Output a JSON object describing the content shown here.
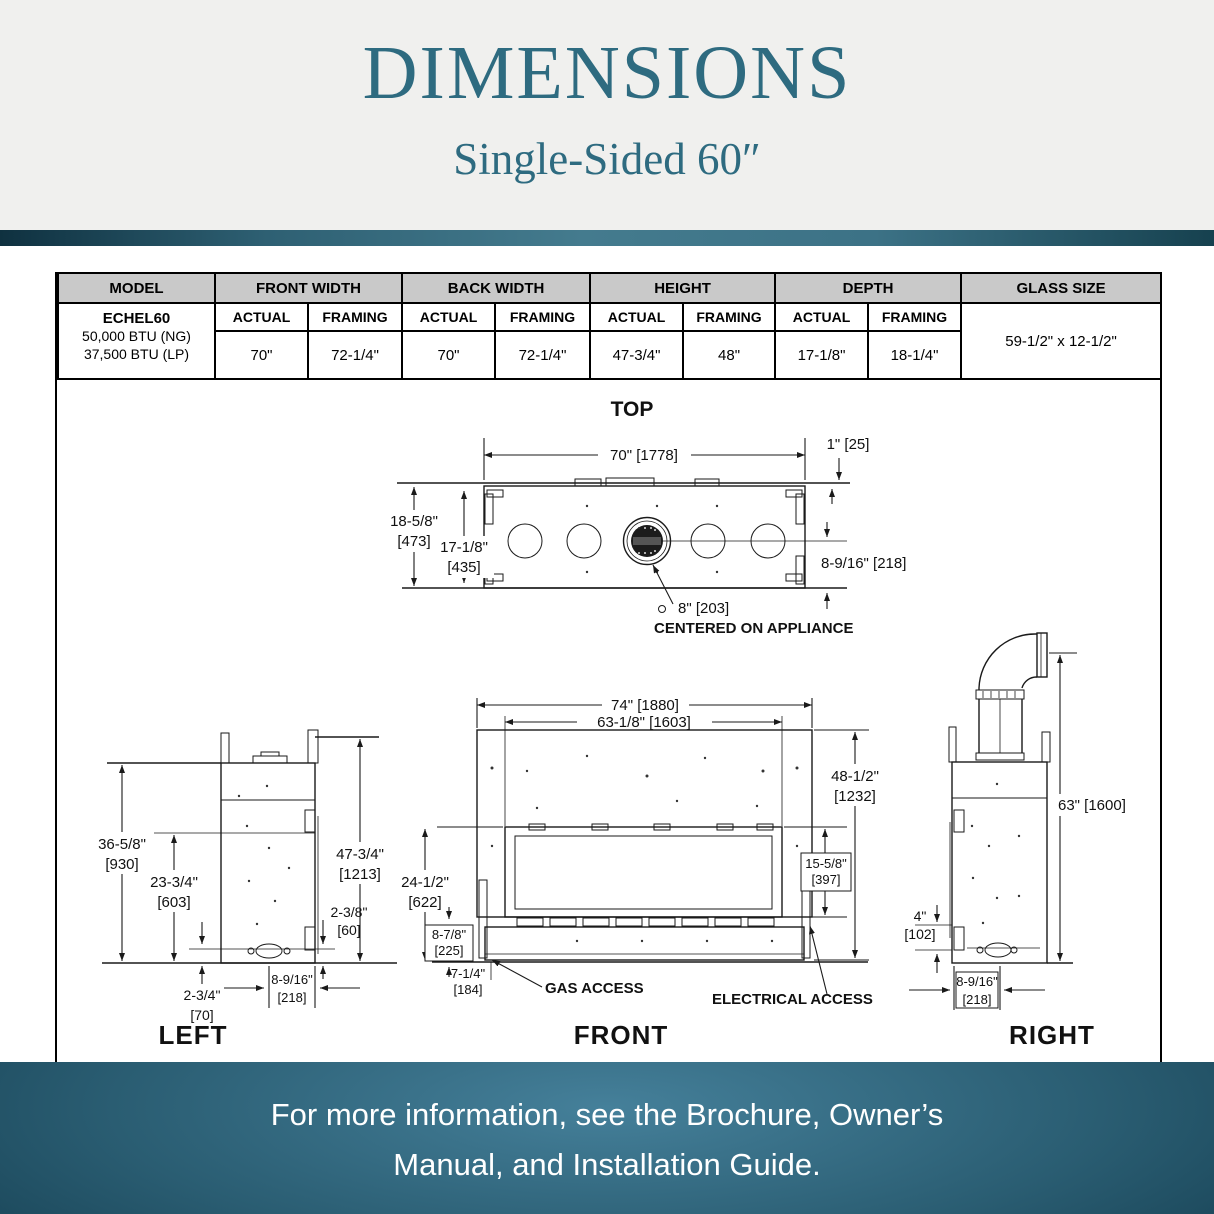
{
  "header": {
    "title": "DIMENSIONS",
    "subtitle": "Single-Sided 60″"
  },
  "spec_table": {
    "model_header": "MODEL",
    "group_headers": [
      "FRONT WIDTH",
      "BACK WIDTH",
      "HEIGHT",
      "DEPTH"
    ],
    "glass_header": "GLASS SIZE",
    "sub_headers": [
      "ACTUAL",
      "FRAMING",
      "ACTUAL",
      "FRAMING",
      "ACTUAL",
      "FRAMING",
      "ACTUAL",
      "FRAMING"
    ],
    "model_name": "ECHEL60",
    "model_btu_ng": "50,000 BTU (NG)",
    "model_btu_lp": "37,500 BTU (LP)",
    "values": [
      "70\"",
      "72-1/4\"",
      "70\"",
      "72-1/4\"",
      "47-3/4\"",
      "48\"",
      "17-1/8\"",
      "18-1/4\""
    ],
    "glass_value": "59-1/2\" x 12-1/2\""
  },
  "views": {
    "top": {
      "title": "TOP",
      "width": "70\" [1778]",
      "flange": "1\" [25]",
      "depth_outer_in": "18-5/8\"",
      "depth_outer_mm": "[473]",
      "depth_inner_in": "17-1/8\"",
      "depth_inner_mm": "[435]",
      "flue_offset": "8-9/16\" [218]",
      "flue_dia": "8\" [203]",
      "flue_note": "CENTERED ON APPLIANCE"
    },
    "left": {
      "title": "LEFT",
      "h1_in": "36-5/8\"",
      "h1_mm": "[930]",
      "h2_in": "23-3/4\"",
      "h2_mm": "[603]",
      "h3_in": "47-3/4\"",
      "h3_mm": "[1213]",
      "d1_in": "2-3/8\"",
      "d1_mm": "[60]",
      "d2_in": "2-3/4\"",
      "d2_mm": "[70]",
      "d3_in": "8-9/16\"",
      "d3_mm": "[218]"
    },
    "front": {
      "title": "FRONT",
      "w1": "74\" [1880]",
      "w2": "63-1/8\" [1603]",
      "h1_in": "48-1/2\"",
      "h1_mm": "[1232]",
      "h2_in": "24-1/2\"",
      "h2_mm": "[622]",
      "h3_in": "15-5/8\"",
      "h3_mm": "[397]",
      "h4_in": "8-7/8\"",
      "h4_mm": "[225]",
      "h5_in": "7-1/4\"",
      "h5_mm": "[184]",
      "gas": "GAS ACCESS",
      "electrical": "ELECTRICAL ACCESS"
    },
    "right": {
      "title": "RIGHT",
      "h1": "63\" [1600]",
      "h2_in": "4\"",
      "h2_mm": "[102]",
      "d1_in": "8-9/16\"",
      "d1_mm": "[218]"
    }
  },
  "footer": {
    "line1": "For more information, see the Brochure, Owner’s",
    "line2": "Manual, and Installation Guide."
  },
  "colors": {
    "accent": "#2E6B80",
    "band_dark": "#16414F",
    "band_light": "#447B8E",
    "footer_center": "#45809A",
    "footer_edge": "#133C4E",
    "table_header_bg": "#C9C9C9",
    "line": "#1A1A1A"
  }
}
